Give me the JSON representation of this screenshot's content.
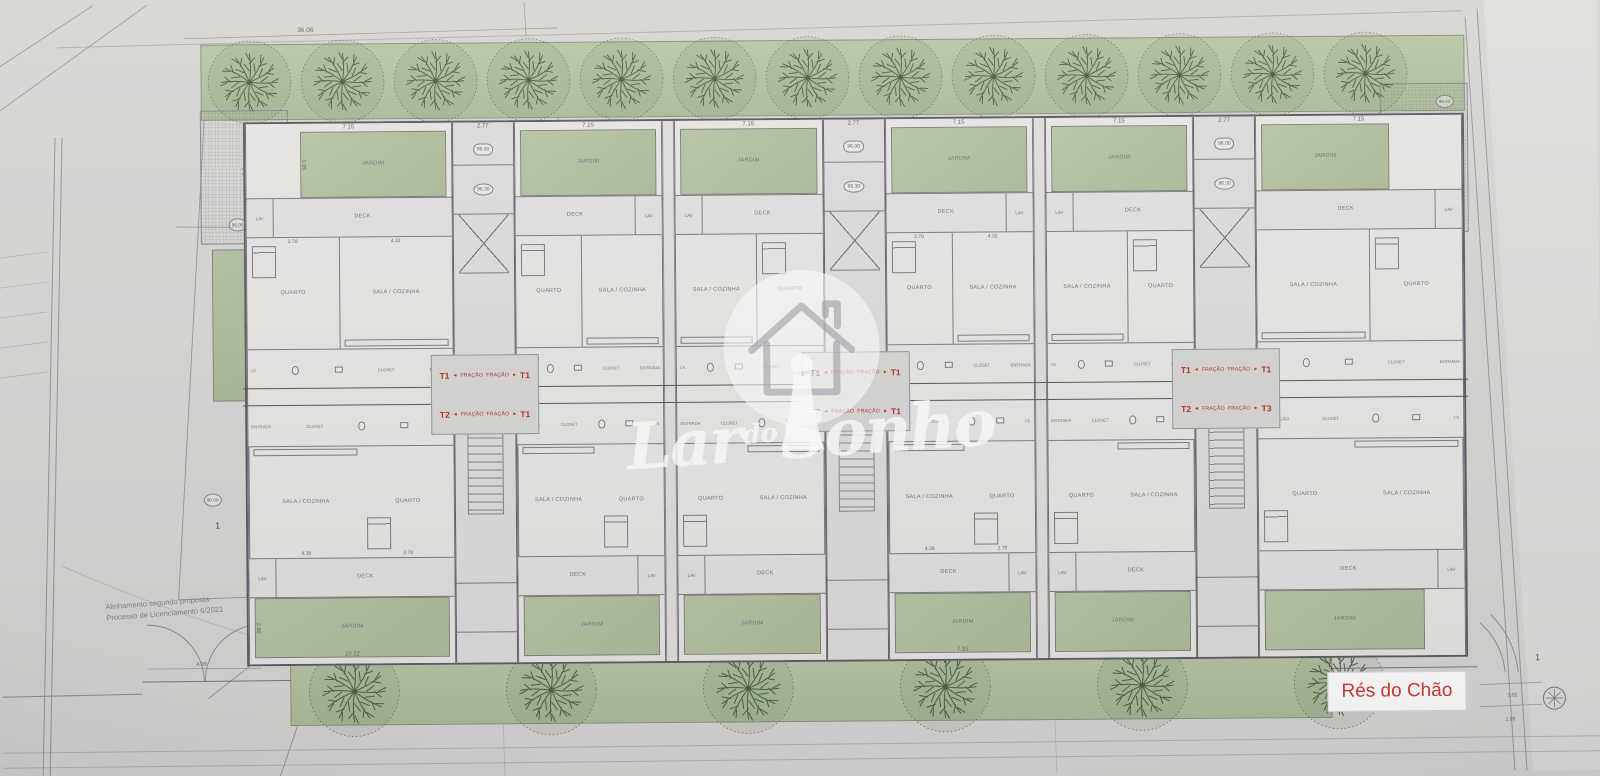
{
  "sheet": {
    "floor_label": "Rés do Chão",
    "note_line1": "Alinhamento segundo proposta",
    "note_line2": "Processo de Licenciamento 6/2021"
  },
  "watermark": {
    "word1": "Lar",
    "word2": "do",
    "word3": "Sonho"
  },
  "rooms": {
    "jardim": "JARDIM",
    "deck": "DECK",
    "lav": "LAV",
    "quarto": "QUARTO",
    "sala": "SALA / COZINHA",
    "is": "I.S.",
    "entrada": "ENTRADA",
    "closet": "CLOSET",
    "circulacao": "CIRCULAÇÃO"
  },
  "fracao_label": "FRAÇÃO",
  "fracao_arrows": {
    "l": "◄",
    "r": "►"
  },
  "site_labels": {
    "lot_number": "1",
    "cote_plaza_left": "96.00",
    "cote_lower_left": "96.00",
    "cote_core_upper": "96.00",
    "cote_core_lower": "96.30",
    "cote_plaza_right": "96.40"
  },
  "dimensions": {
    "top_overall": "36.06",
    "top_strip": "7.63",
    "jardim_width": "7.15",
    "core_width": "2.77",
    "quarto_w": "2.70",
    "sala_w": "4.32",
    "hall_w": "2.48",
    "quarto_w_b": "2.70",
    "sala_w_b": "4.38",
    "bottom_jardim_m1": "10.22",
    "bottom_jardim_m4": "7.15",
    "jardim_height": "3.95",
    "bottom_jardim_height": "2.86",
    "gate_span": "4.99",
    "corner_a": "1.02",
    "corner_b": "1.00"
  },
  "cores": [
    {
      "t_top_left": "T1",
      "t_top_right": "T1",
      "t_bottom_left": "T2",
      "t_bottom_right": "T1"
    },
    {
      "t_top_left": "T1",
      "t_top_right": "T1",
      "t_bottom_left": "T2",
      "t_bottom_right": "T1"
    },
    {
      "t_top_left": "T1",
      "t_top_right": "T1",
      "t_bottom_left": "T2",
      "t_bottom_right": "T3"
    }
  ],
  "blocks": [
    {
      "type": "unit",
      "variant": "end-left",
      "size": "lg",
      "lav": "left",
      "mirrored": false,
      "show_room_dims": true,
      "bottom_dim_key": "bottom_jardim_m1"
    },
    {
      "type": "core",
      "core_index": 0
    },
    {
      "type": "unit",
      "lav": "right",
      "mirrored": false
    },
    {
      "type": "sep"
    },
    {
      "type": "unit",
      "lav": "left",
      "mirrored": true
    },
    {
      "type": "core",
      "core_index": 1
    },
    {
      "type": "unit",
      "lav": "right",
      "mirrored": false,
      "show_room_dims": true,
      "bottom_dim_key": "bottom_jardim_m4"
    },
    {
      "type": "sep"
    },
    {
      "type": "unit",
      "lav": "left",
      "mirrored": true
    },
    {
      "type": "core",
      "core_index": 2
    },
    {
      "type": "unit",
      "variant": "end-right",
      "size": "lg",
      "lav": "right",
      "mirrored": true,
      "circ": true
    }
  ],
  "trees": {
    "top_count": 13,
    "bottom_count": 6
  }
}
